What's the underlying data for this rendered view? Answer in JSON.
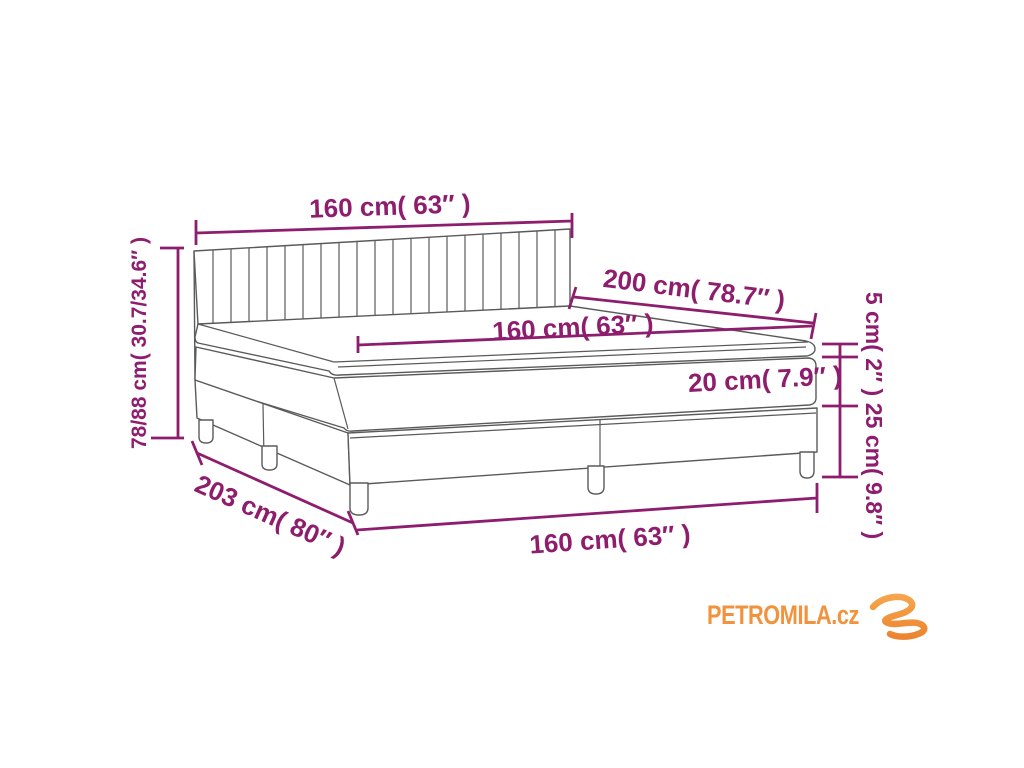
{
  "diagram": {
    "type": "product-dimension-diagram",
    "subject": "box spring bed with headboard, mattress and topper",
    "colors": {
      "dimension_annotation": "#8e1d6e",
      "drawing_outline": "#5a5a5a",
      "logo_orange": "#f2923d",
      "background": "#ffffff"
    },
    "labels": {
      "headboard_width": "160 cm( 63″ )",
      "bed_length": "200 cm( 78.7″ )",
      "mattress_width": "160 cm( 63″ )",
      "topper_height": "5 cm( 2″ )",
      "mattress_height": "20 cm( 7.9″ )",
      "base_height": "25 cm( 9.8″ )",
      "total_height": "78/88 cm( 30.7/34.6″ )",
      "total_length": "203 cm( 80″ )",
      "base_width": "160 cm( 63″ )"
    }
  },
  "logo": {
    "text": "PETROMILA.cz"
  }
}
